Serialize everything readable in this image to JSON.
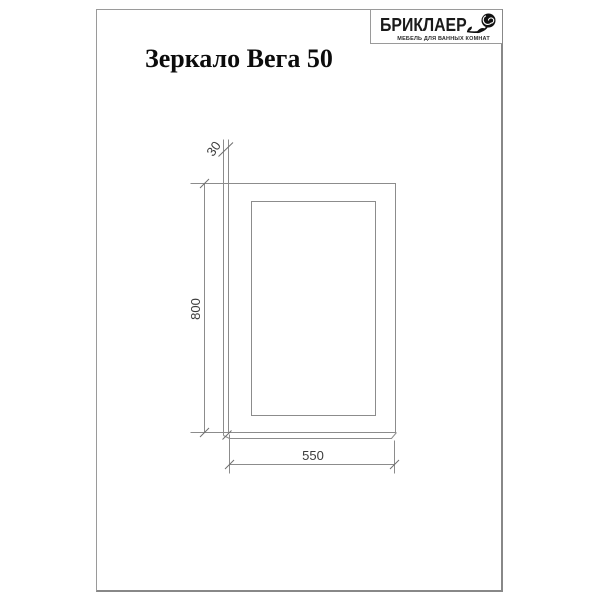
{
  "page": {
    "title": "Зеркало Вега 50"
  },
  "logo": {
    "brand": "БРИКЛАЕР",
    "tagline": "МЕБЕЛЬ ДЛЯ ВАННЫХ КОМНАТ",
    "icon": "rose-icon"
  },
  "drawing": {
    "type": "technical-dimension-diagram",
    "product": "Зеркало Вега 50",
    "dimensions": {
      "width_mm": "550",
      "height_mm": "800",
      "depth_mm": "30"
    },
    "line_color": "#8c8c8c",
    "text_color": "#3c3c3c"
  }
}
